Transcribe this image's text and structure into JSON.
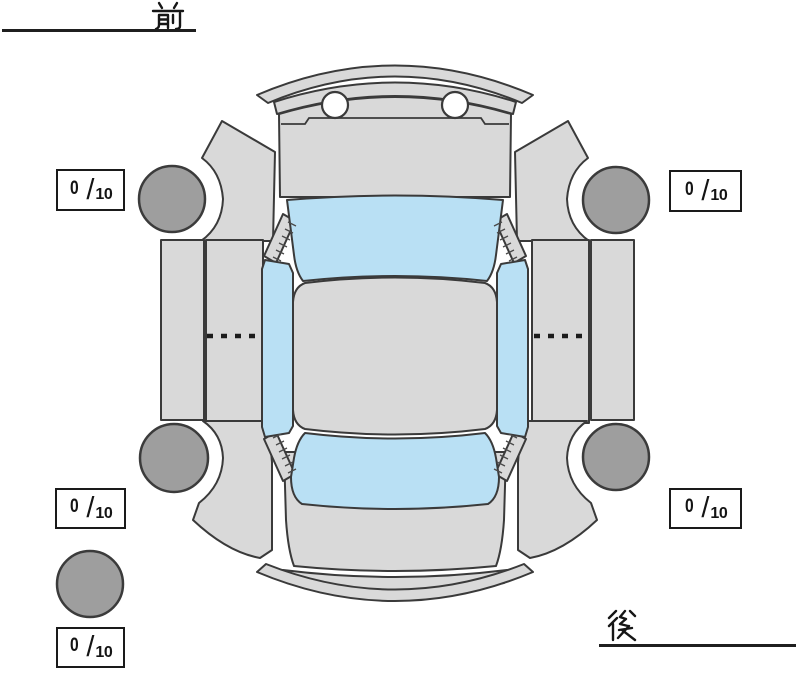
{
  "labels": {
    "front": "前",
    "rear": "後"
  },
  "tread_boxes": {
    "front_left": {
      "value": "0",
      "slash": "/",
      "max": "10"
    },
    "front_right": {
      "value": "0",
      "slash": "/",
      "max": "10"
    },
    "rear_left": {
      "value": "0",
      "slash": "/",
      "max": "10"
    },
    "rear_right": {
      "value": "0",
      "slash": "/",
      "max": "10"
    },
    "spare": {
      "value": "0",
      "slash": "/",
      "max": "10"
    }
  },
  "colors": {
    "background": "#ffffff",
    "body": "#d9d9d9",
    "window": "#b9e0f4",
    "tire": "#9e9e9e",
    "outline": "#3a3a3a",
    "headlight": "#ffffff",
    "text": "#141414"
  }
}
